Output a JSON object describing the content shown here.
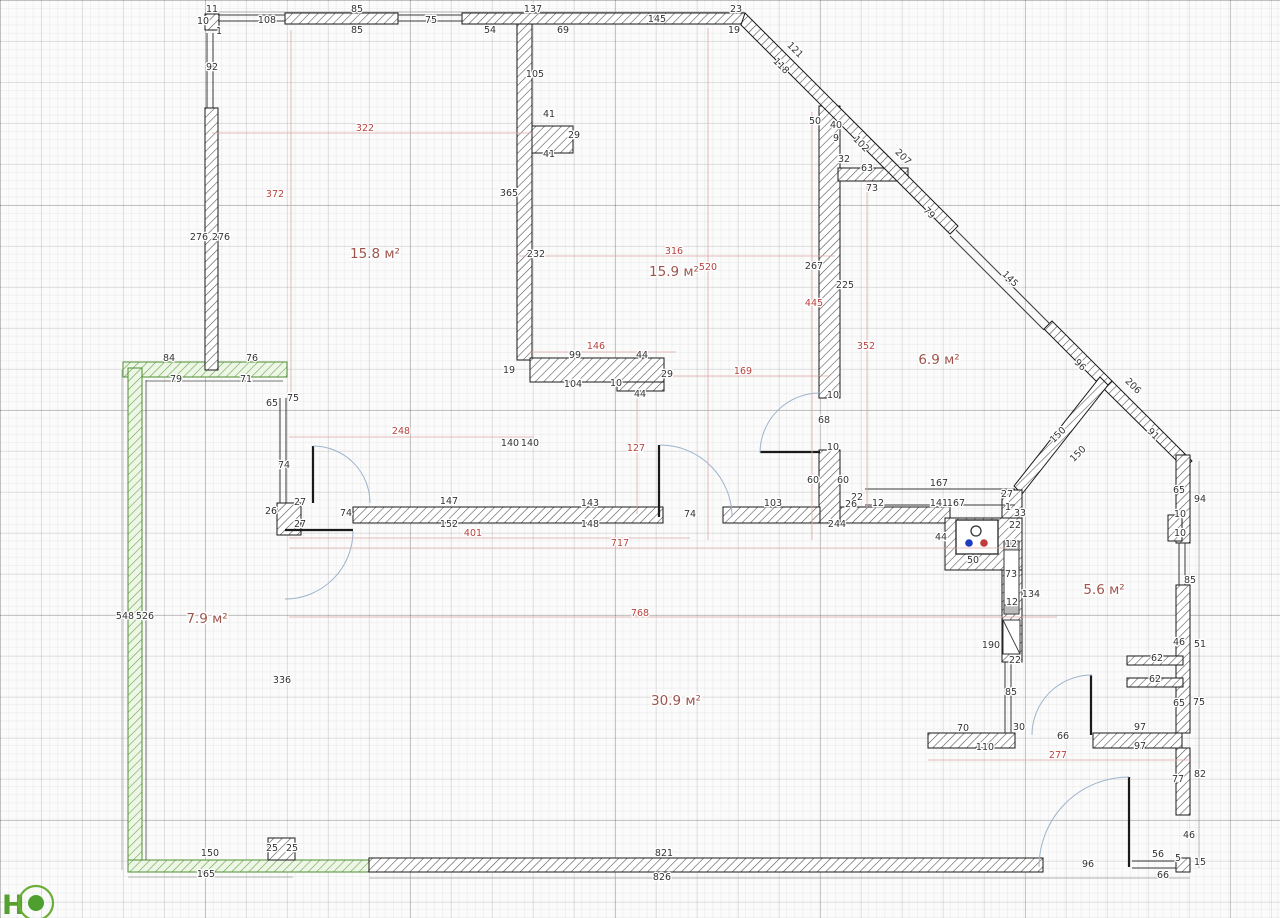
{
  "logo": {
    "letter": "Н"
  },
  "colors": {
    "dim_black": "#333333",
    "dim_red": "#b8423d",
    "dim_red_line": "#dba8a5",
    "room_label": "#9e544c",
    "door_arc": "#9db3cc",
    "logo_green": "#55a02e",
    "wall_hatch": "#555555",
    "green_wall": "#63a843"
  },
  "rooms": [
    {
      "t": "15.8 м²",
      "x": 375,
      "y": 258
    },
    {
      "t": "15.9 м²",
      "x": 674,
      "y": 276
    },
    {
      "t": "6.9 м²",
      "x": 939,
      "y": 364
    },
    {
      "t": "5.6 м²",
      "x": 1104,
      "y": 594
    },
    {
      "t": "7.9 м²",
      "x": 207,
      "y": 623
    },
    {
      "t": "30.9 м²",
      "x": 676,
      "y": 705
    }
  ],
  "dims_black": [
    [
      "11",
      212,
      12
    ],
    [
      "10",
      203,
      24
    ],
    [
      "1",
      219,
      34
    ],
    [
      "108",
      267,
      23
    ],
    [
      "85",
      357,
      12
    ],
    [
      "85",
      357,
      33
    ],
    [
      "75",
      431,
      23
    ],
    [
      "137",
      533,
      12
    ],
    [
      "54",
      490,
      33
    ],
    [
      "69",
      563,
      33
    ],
    [
      "92",
      212,
      70
    ],
    [
      "276",
      199,
      240
    ],
    [
      "276",
      221,
      240
    ],
    [
      "105",
      535,
      77
    ],
    [
      "41",
      549,
      117
    ],
    [
      "29",
      574,
      138
    ],
    [
      "41",
      549,
      157
    ],
    [
      "365",
      509,
      196
    ],
    [
      "232",
      536,
      257
    ],
    [
      "267",
      814,
      269
    ],
    [
      "225",
      845,
      288
    ],
    [
      "23",
      736,
      12
    ],
    [
      "19",
      734,
      33
    ],
    [
      "145",
      657,
      22
    ],
    [
      "121",
      793,
      52,
      45
    ],
    [
      "118",
      779,
      68,
      45
    ],
    [
      "50",
      815,
      124
    ],
    [
      "40",
      836,
      128
    ],
    [
      "9",
      836,
      141
    ],
    [
      "102",
      859,
      146,
      45
    ],
    [
      "207",
      901,
      159,
      45
    ],
    [
      "32",
      844,
      162
    ],
    [
      "63",
      867,
      171
    ],
    [
      "73",
      872,
      191
    ],
    [
      "79",
      927,
      215,
      45
    ],
    [
      "145",
      1008,
      281,
      45
    ],
    [
      "96",
      1078,
      367,
      45
    ],
    [
      "206",
      1131,
      388,
      45
    ],
    [
      "91",
      1151,
      436,
      45
    ],
    [
      "150",
      1060,
      437,
      -45
    ],
    [
      "150",
      1080,
      456,
      -45
    ],
    [
      "84",
      169,
      361
    ],
    [
      "76",
      252,
      361
    ],
    [
      "79",
      176,
      382
    ],
    [
      "71",
      246,
      382
    ],
    [
      "65",
      272,
      406
    ],
    [
      "75",
      293,
      401
    ],
    [
      "74",
      284,
      468
    ],
    [
      "26",
      271,
      514
    ],
    [
      "27",
      300,
      505
    ],
    [
      "27",
      300,
      527
    ],
    [
      "74",
      346,
      516
    ],
    [
      "147",
      449,
      504
    ],
    [
      "152",
      449,
      527
    ],
    [
      "140",
      510,
      446
    ],
    [
      "140",
      530,
      446
    ],
    [
      "143",
      590,
      506
    ],
    [
      "148",
      590,
      527
    ],
    [
      "74",
      690,
      517
    ],
    [
      "103",
      773,
      506
    ],
    [
      "244",
      837,
      527
    ],
    [
      "19",
      509,
      373
    ],
    [
      "99",
      575,
      358
    ],
    [
      "44",
      642,
      358
    ],
    [
      "29",
      667,
      377
    ],
    [
      "104",
      573,
      387
    ],
    [
      "10",
      616,
      386
    ],
    [
      "44",
      640,
      397
    ],
    [
      "10",
      833,
      398
    ],
    [
      "68",
      824,
      423
    ],
    [
      "10",
      833,
      450
    ],
    [
      "60",
      813,
      483
    ],
    [
      "60",
      843,
      483
    ],
    [
      "22",
      857,
      500
    ],
    [
      "26",
      851,
      507
    ],
    [
      "12",
      878,
      506
    ],
    [
      "167",
      939,
      486
    ],
    [
      "141",
      939,
      506
    ],
    [
      "167",
      956,
      506
    ],
    [
      "27",
      1007,
      497
    ],
    [
      "44",
      941,
      540
    ],
    [
      "50",
      973,
      563
    ],
    [
      "1",
      1008,
      510
    ],
    [
      "33",
      1020,
      516
    ],
    [
      "22",
      1015,
      528
    ],
    [
      "12",
      1011,
      547
    ],
    [
      "73",
      1011,
      577
    ],
    [
      "12",
      1012,
      605
    ],
    [
      "134",
      1031,
      597
    ],
    [
      "190",
      991,
      648
    ],
    [
      "22",
      1015,
      663
    ],
    [
      "85",
      1011,
      695
    ],
    [
      "65",
      1179,
      493
    ],
    [
      "94",
      1200,
      502
    ],
    [
      "10",
      1180,
      517
    ],
    [
      "10",
      1180,
      536
    ],
    [
      "85",
      1190,
      583
    ],
    [
      "46",
      1179,
      645
    ],
    [
      "51",
      1200,
      647
    ],
    [
      "62",
      1157,
      661
    ],
    [
      "62",
      1155,
      682
    ],
    [
      "65",
      1179,
      706
    ],
    [
      "75",
      1199,
      705
    ],
    [
      "30",
      1019,
      730
    ],
    [
      "70",
      963,
      731
    ],
    [
      "110",
      985,
      750
    ],
    [
      "66",
      1063,
      739
    ],
    [
      "97",
      1140,
      730
    ],
    [
      "97",
      1140,
      749
    ],
    [
      "77",
      1178,
      782
    ],
    [
      "82",
      1200,
      777
    ],
    [
      "46",
      1189,
      838
    ],
    [
      "56",
      1158,
      857
    ],
    [
      "5",
      1178,
      861
    ],
    [
      "15",
      1200,
      865
    ],
    [
      "96",
      1088,
      867
    ],
    [
      "66",
      1163,
      878
    ],
    [
      "548",
      125,
      619
    ],
    [
      "526",
      145,
      619
    ],
    [
      "336",
      282,
      683
    ],
    [
      "150",
      210,
      856
    ],
    [
      "25",
      272,
      851
    ],
    [
      "25",
      292,
      851
    ],
    [
      "165",
      206,
      877
    ],
    [
      "821",
      664,
      856
    ],
    [
      "826",
      662,
      880
    ]
  ],
  "dims_red": [
    [
      "322",
      365,
      131
    ],
    [
      "372",
      275,
      197
    ],
    [
      "316",
      674,
      254
    ],
    [
      "520",
      708,
      270
    ],
    [
      "146",
      596,
      349
    ],
    [
      "169",
      743,
      374
    ],
    [
      "352",
      866,
      349
    ],
    [
      "445",
      814,
      306
    ],
    [
      "248",
      401,
      434
    ],
    [
      "127",
      636,
      451
    ],
    [
      "401",
      473,
      536
    ],
    [
      "717",
      620,
      546
    ],
    [
      "768",
      640,
      616
    ],
    [
      "277",
      1058,
      758
    ]
  ]
}
